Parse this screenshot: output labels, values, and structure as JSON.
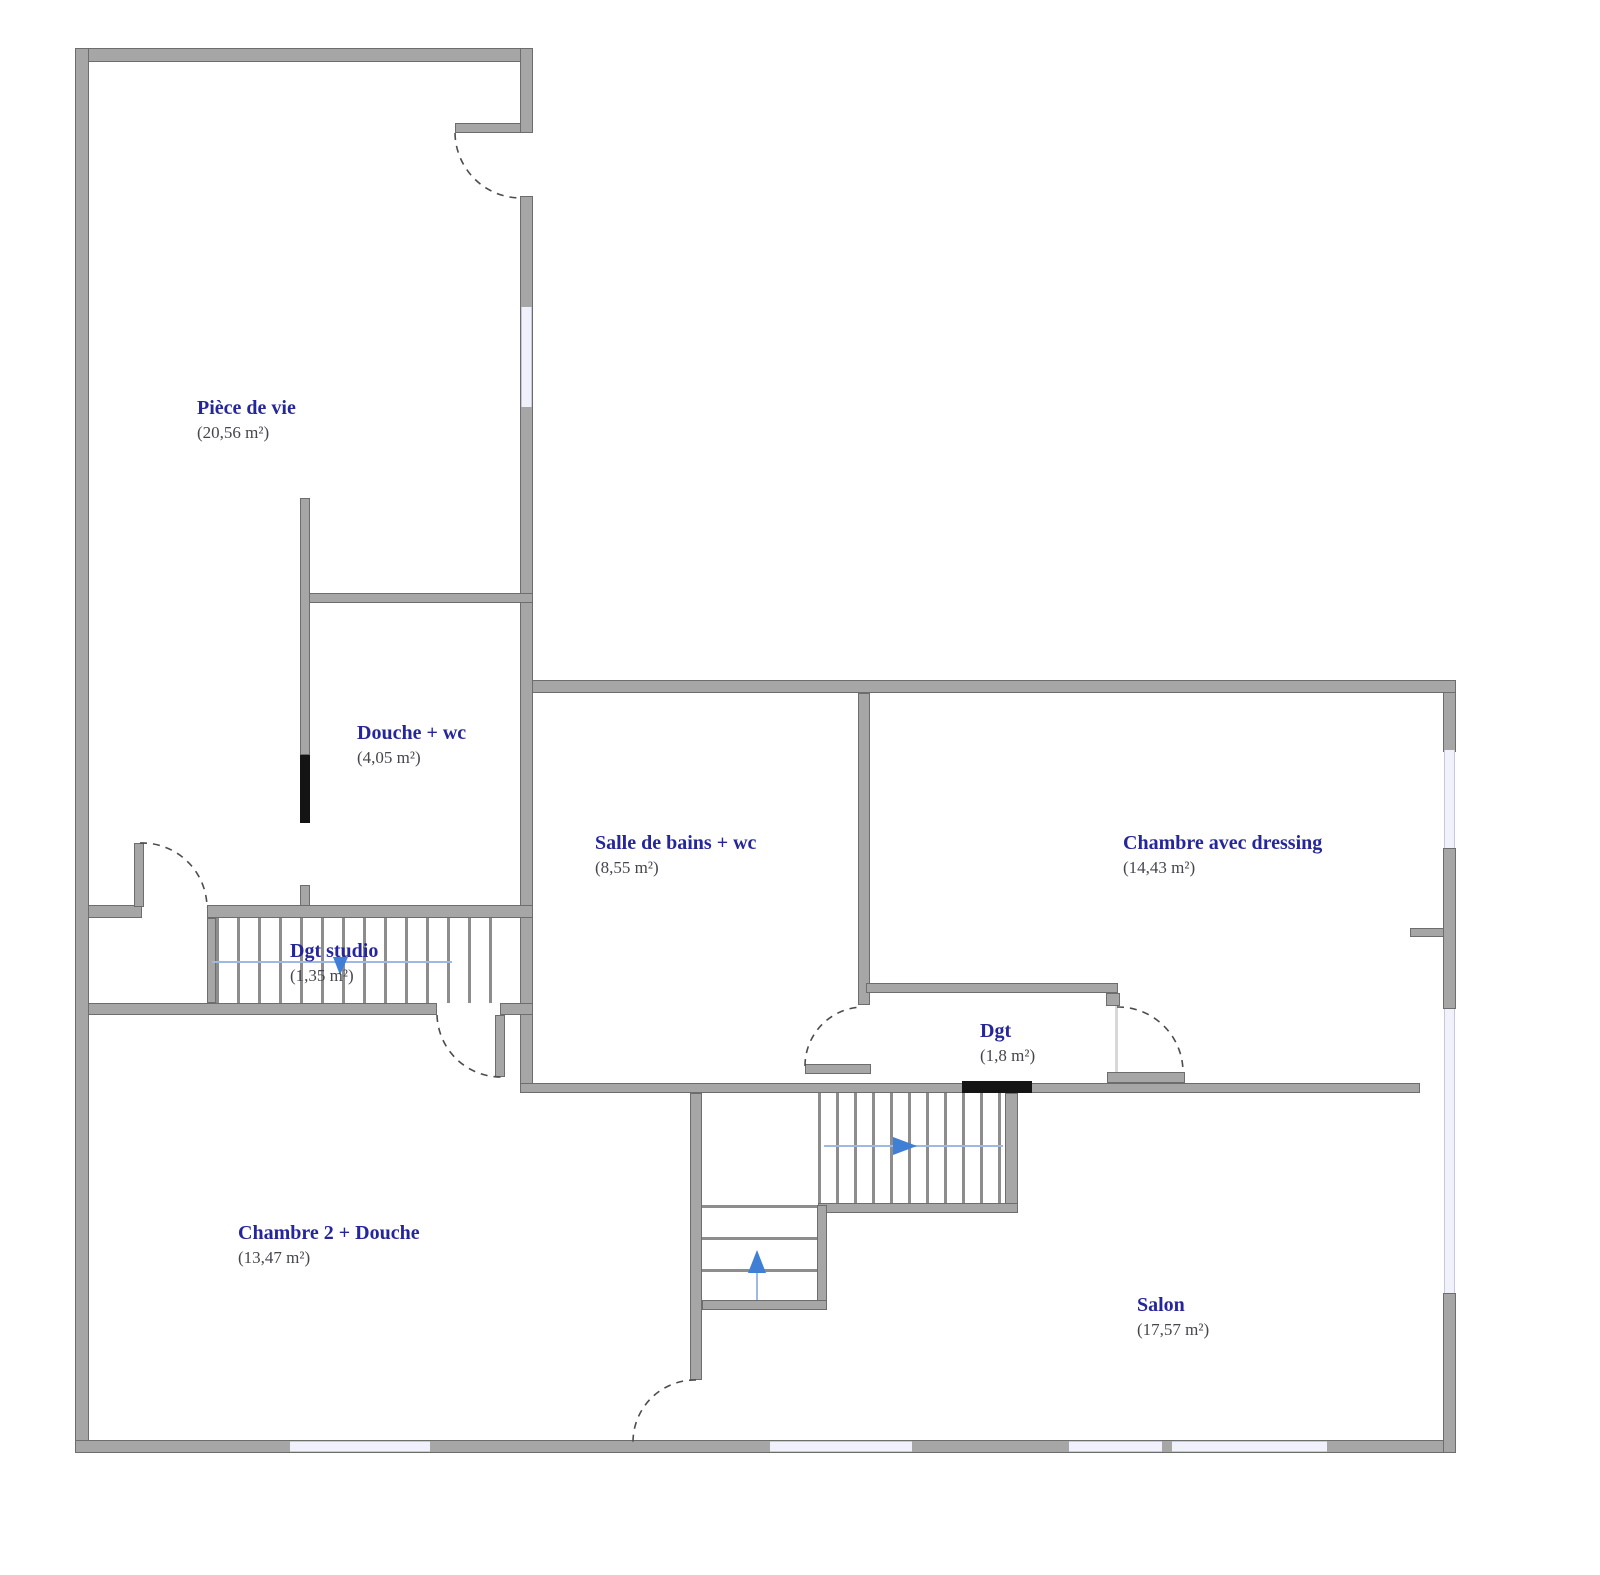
{
  "plan": {
    "rooms": [
      {
        "name": "Pièce de vie",
        "area": "(20,56 m²)"
      },
      {
        "name": "Douche + wc",
        "area": "(4,05 m²)"
      },
      {
        "name": "Salle de bains + wc",
        "area": "(8,55 m²)"
      },
      {
        "name": "Chambre avec dressing",
        "area": "(14,43 m²)"
      },
      {
        "name": "Dgt studio",
        "area": "(1,35 m²)"
      },
      {
        "name": "Dgt",
        "area": "(1,8 m²)"
      },
      {
        "name": "Chambre 2 + Douche",
        "area": "(13,47 m²)"
      },
      {
        "name": "Salon",
        "area": "(17,57 m²)"
      }
    ],
    "colors": {
      "room_label": "#26269b",
      "area_label": "#45454d",
      "wall": "#a6a6a6",
      "wall_outline": "#6d6d6d",
      "black_wall": "#141414",
      "window": "#f0f1fb",
      "stair_guide": "#9dbbe0",
      "stair_arrow": "#3f7fd6"
    }
  }
}
